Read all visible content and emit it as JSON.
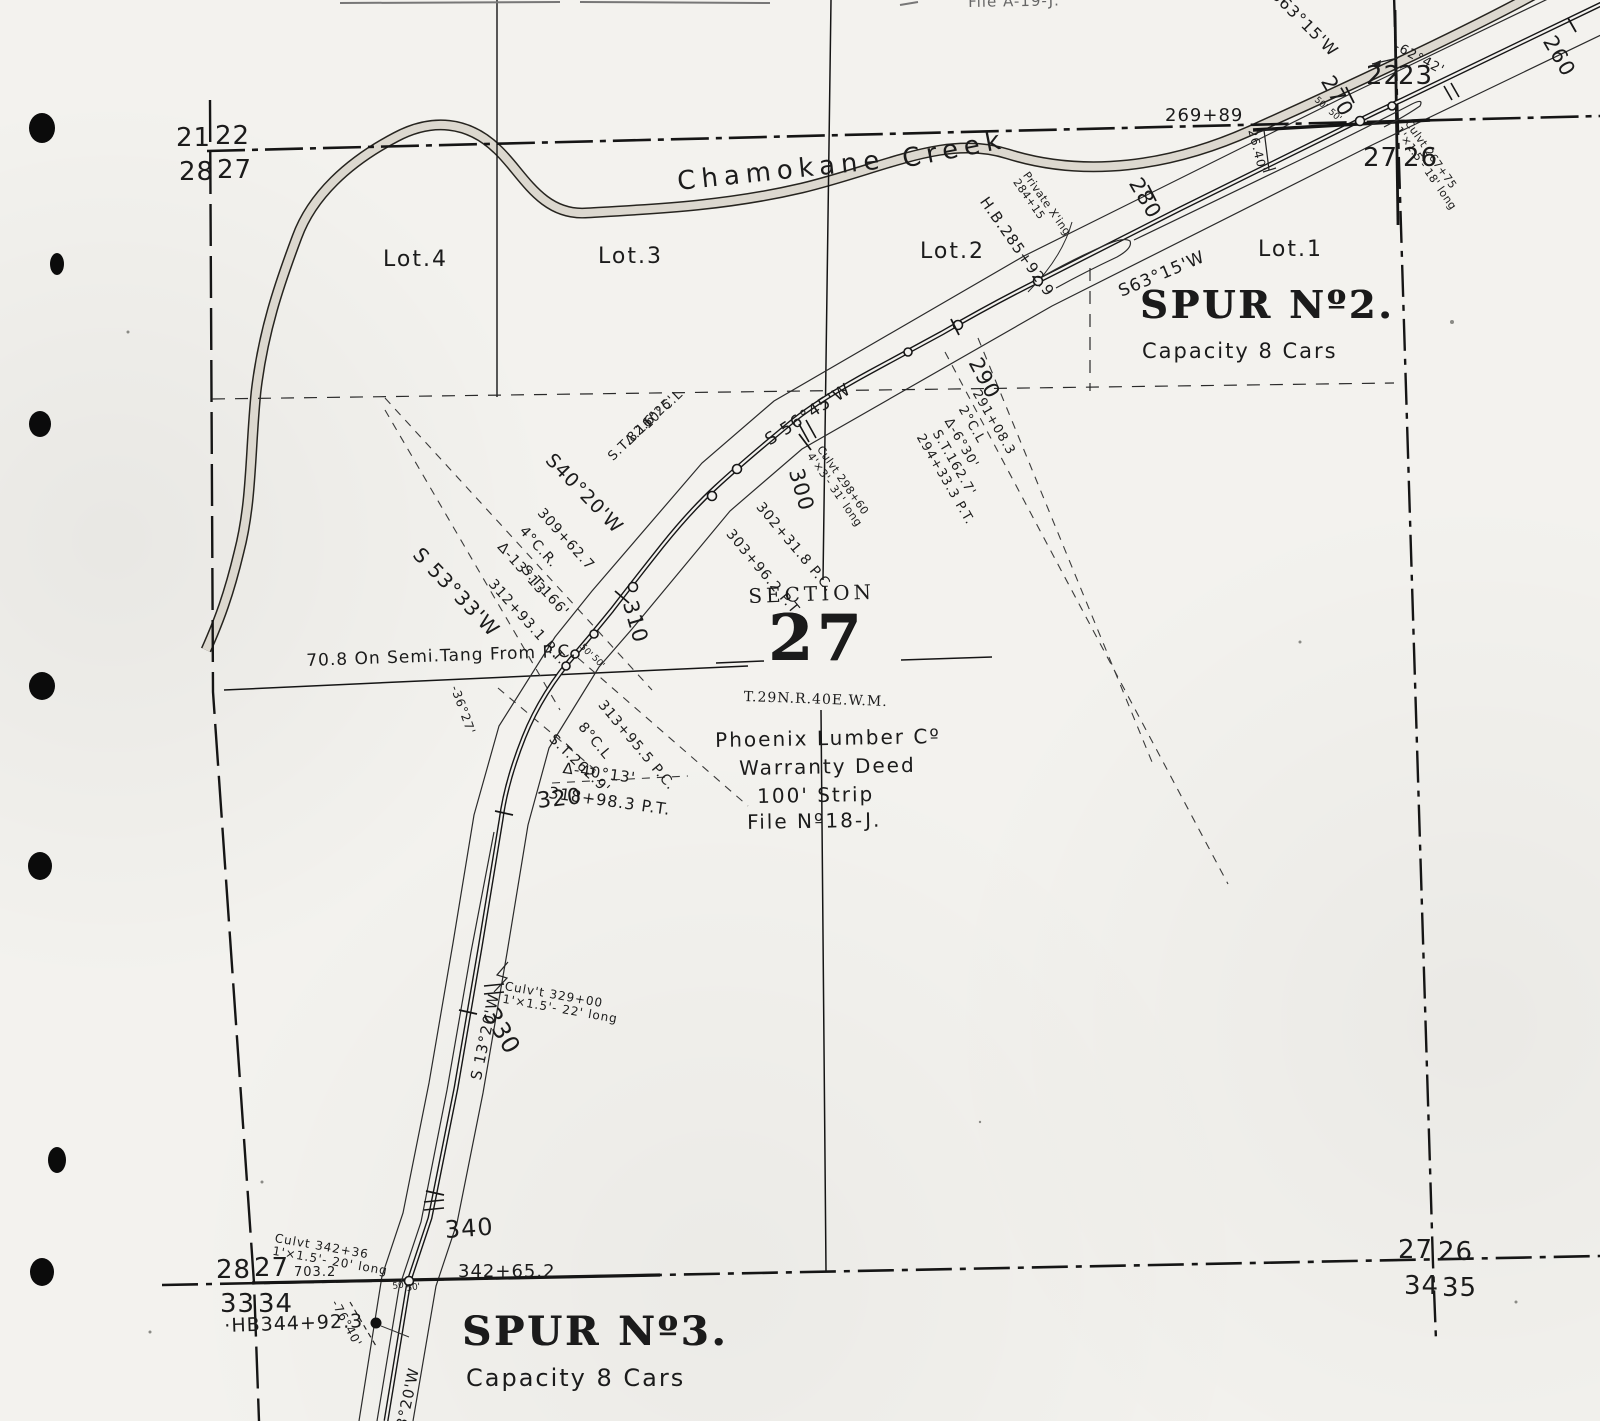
{
  "page": {
    "file_note": "File A-19-J."
  },
  "creek": {
    "word1": "Chamokane",
    "word2": "Creek"
  },
  "lots": {
    "lot4": "Lot.4",
    "lot3": "Lot.3",
    "lot2": "Lot.2",
    "lot1": "Lot.1"
  },
  "section": {
    "arc_top": "SECTION",
    "number": "27",
    "township": "T.29N.R.40E.W.M."
  },
  "spur2": {
    "name": "SPUR Nº2.",
    "capacity": "Capacity 8 Cars"
  },
  "spur3": {
    "name": "SPUR Nº3.",
    "capacity": "Capacity 8 Cars"
  },
  "deed": {
    "owner": "Phoenix Lumber Cº",
    "instrument": "Warranty Deed",
    "strip": "100' Strip",
    "file": "File Nº18-J."
  },
  "corners": {
    "nw": {
      "tl": "21",
      "tr": "22",
      "bl": "28",
      "br": "27"
    },
    "ne": {
      "tl": "22",
      "tr": "23",
      "bl": "27",
      "br": "26"
    },
    "sw": {
      "tl": "28",
      "tr": "27",
      "bl": "33",
      "br": "34"
    },
    "se": {
      "tl": "27",
      "tr": "26",
      "bl": "34",
      "br": "35"
    }
  },
  "stations": {
    "s260": "260",
    "s270": "270",
    "s280": "280",
    "s290": "290",
    "s300": "300",
    "s310": "310",
    "s320": "320",
    "s330": "330",
    "s340": "340"
  },
  "bearings": {
    "b63_top": "S63°15'W",
    "b63_spur": "S63°15'W",
    "b56": "S 56°45'W",
    "b40": "S40°20'W",
    "b53": "S 53°33'W",
    "b13_mid": "S 13°20'W",
    "b13_bot": "S 13°20'W"
  },
  "curves": {
    "c10": {
      "deg": "10°C.L",
      "delta": "Δ.16°25'",
      "st": "S.T.82.6'",
      "pc": "302+31.8 P.C.",
      "pt": "303+96.2 P.T."
    },
    "c4": {
      "sta": "309+62.7",
      "deg": "4°C.R.",
      "delta": "Δ-13°13'",
      "st": "S.T.166'",
      "pt": "312+93.1 P.T."
    },
    "c2": {
      "sta": "291+08.3",
      "deg": "2°C.L",
      "delta": "Δ-6°30'",
      "st": "S.T.162.7'",
      "pt": "294+33.3 P.T."
    },
    "c8": {
      "pc": "313+95.5 P.C.",
      "deg": "8°C.L",
      "st": "S.T.262.9'",
      "delta": "Δ-40°13'",
      "pt": "318+98.3 P.T."
    }
  },
  "culverts": {
    "c267": {
      "l1": "Culvt 267+75",
      "l2": "1'×1.5'- 18' long"
    },
    "c298": {
      "l1": "Culvt 298+60",
      "l2": "4'×3'- 31' long"
    },
    "c329": {
      "l1": "Culv't 329+00",
      "l2": "1'×1.5'- 22' long"
    },
    "c342": {
      "l1": "Culvt 342+36",
      "l2": "1'×1.5'- 20' long"
    }
  },
  "notes": {
    "semi_tang": "70.8 On Semi.Tang From P.C.",
    "sta_269": "269+89",
    "dim_2640": "26.40'",
    "ang_62": "-62°42'",
    "ang_36": "-36°27'",
    "ang_76": "-76°40'",
    "hb285": "H.B.285+92.9",
    "hb344": "·HB344+92.3",
    "xing1": "Private X'ing",
    "xing2": "284+15",
    "sta_342": "342+65.2",
    "dist_703": "703.2",
    "fifty": "50'"
  }
}
